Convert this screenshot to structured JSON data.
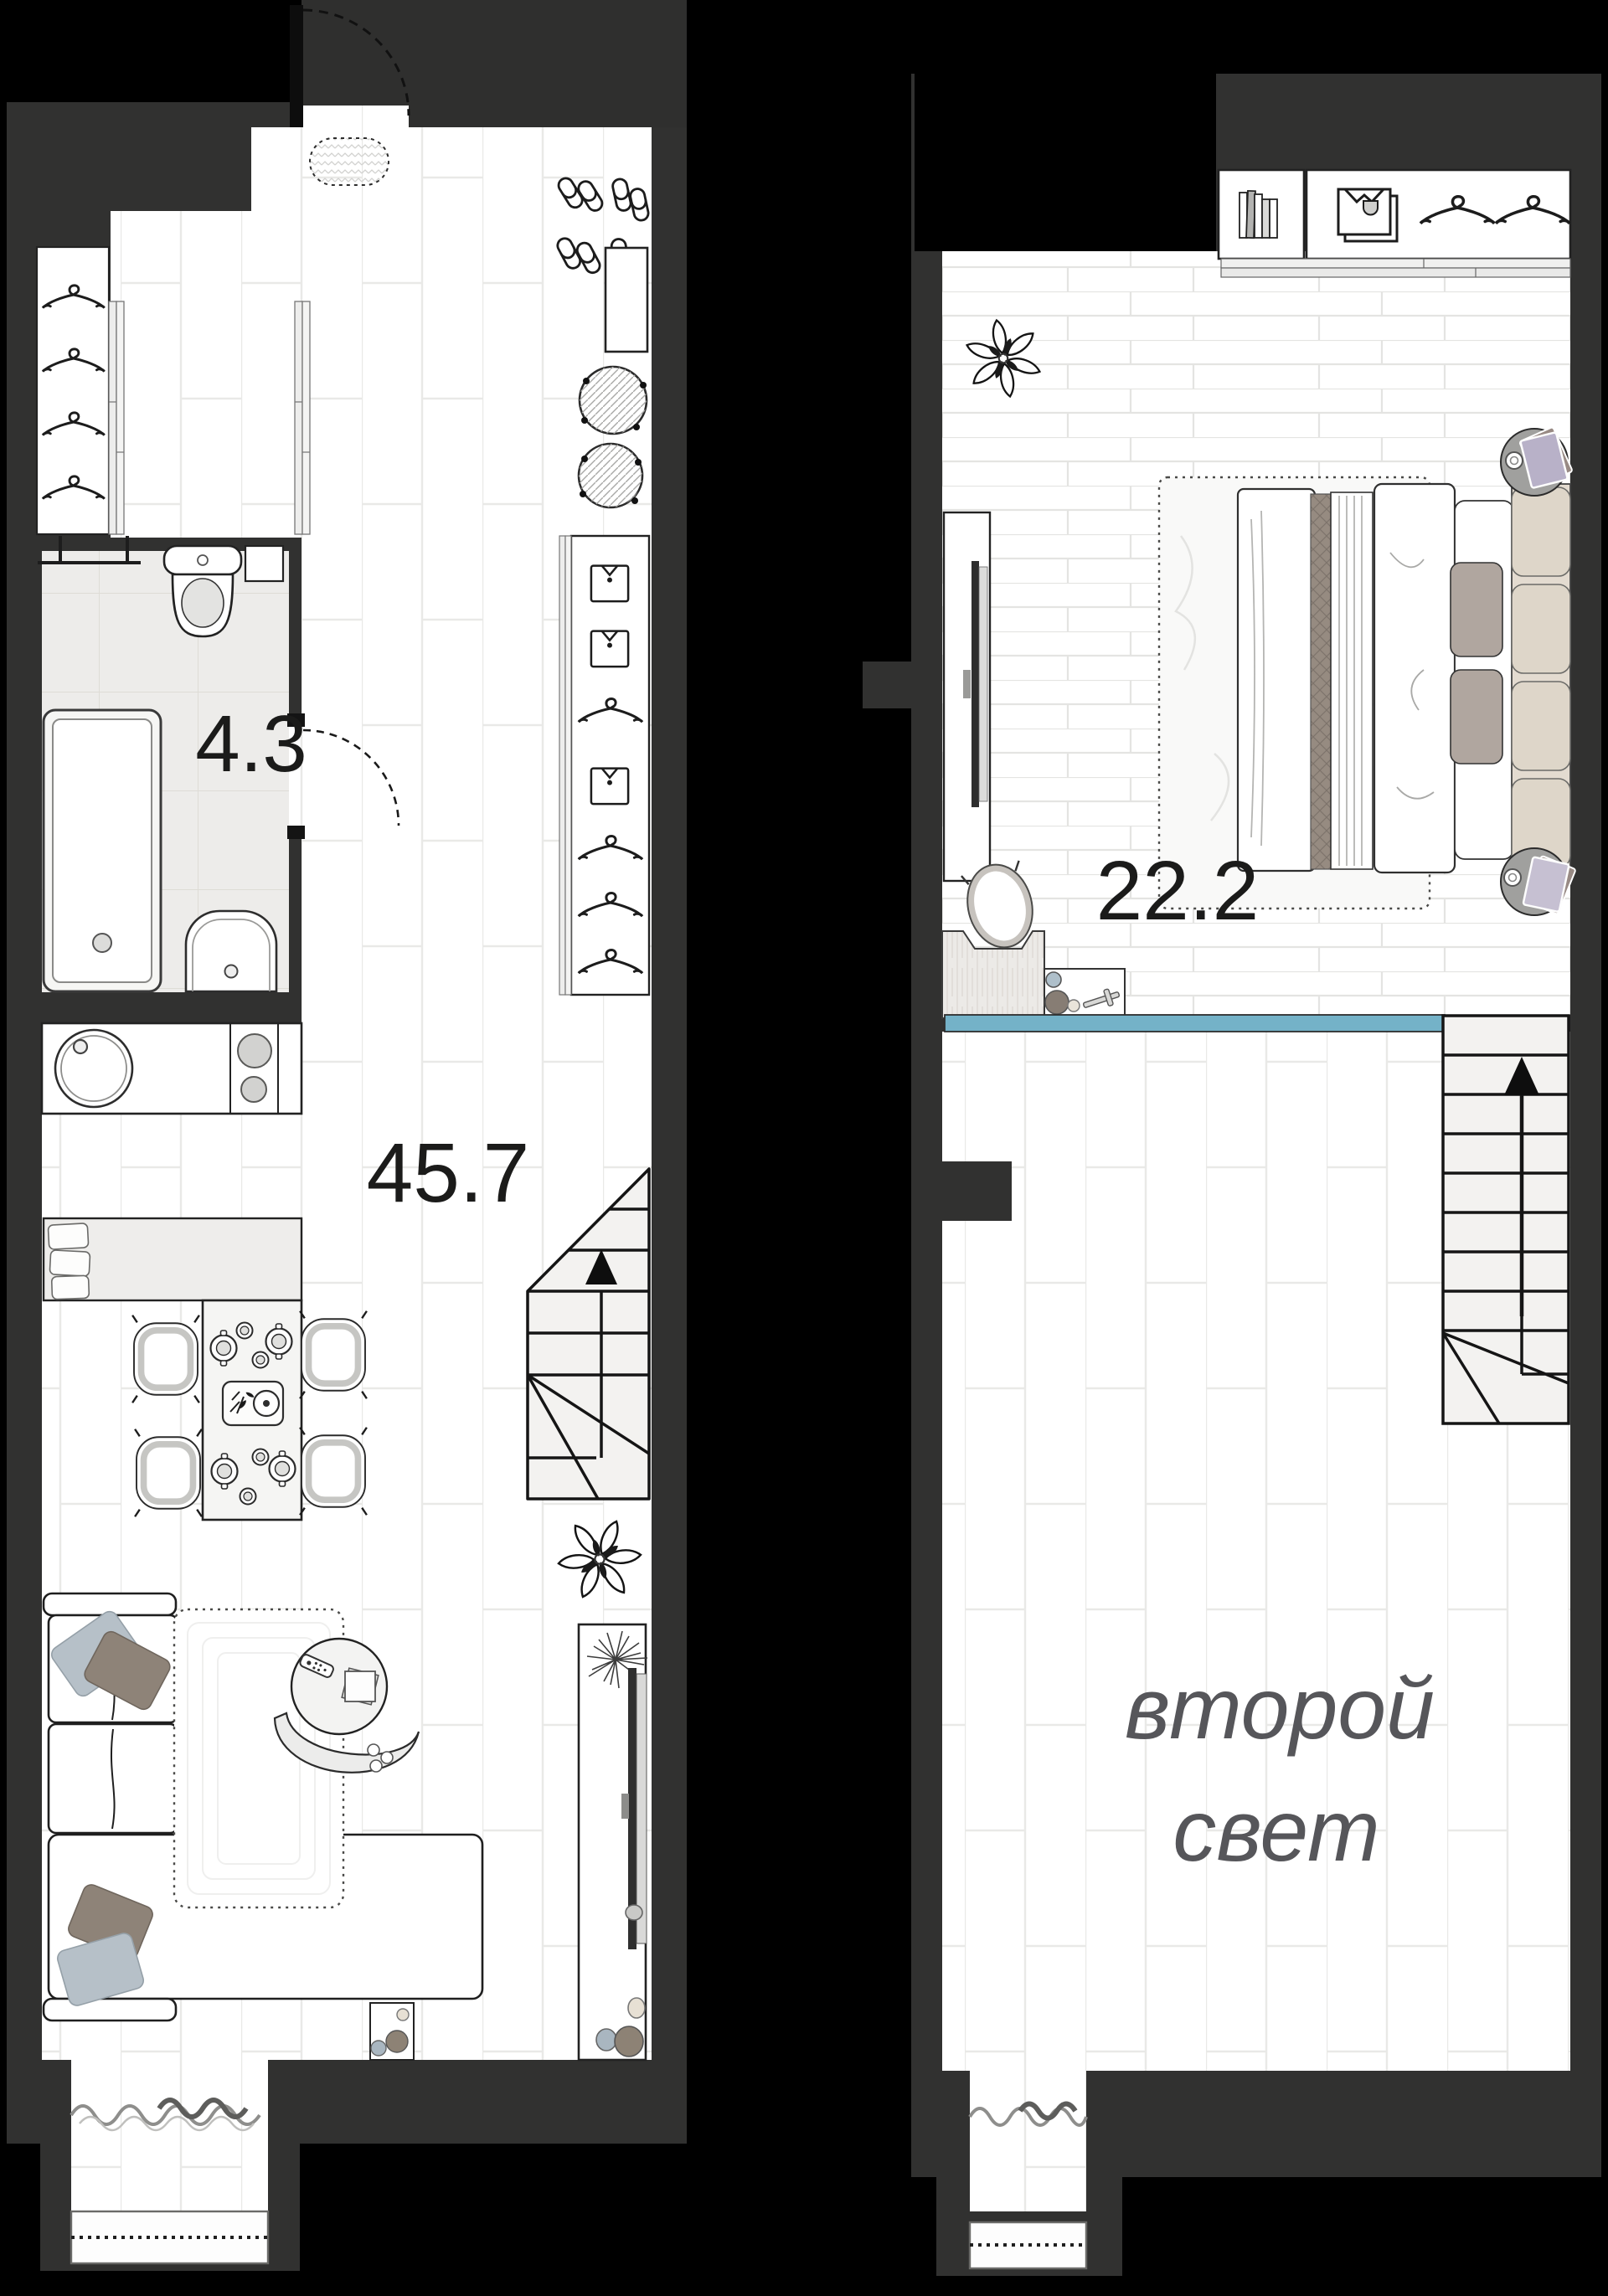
{
  "page": {
    "type": "apartment floor plan, two levels",
    "background": "#000000"
  },
  "palette": {
    "wall": "#313130",
    "wall_light_patch": "#2f2f2e",
    "floor": "#ffffff",
    "floor_line": "#e9e9e7",
    "bathroom_tile": "#edecea",
    "stairs_fill": "#f3f2f0",
    "railing_blue": "#74b2c8",
    "area_label_color": "#1b1b1a",
    "void_label_color": "#56565a",
    "pillow_blue": "#b6c0c8",
    "pillow_brown": "#8e8378",
    "headboard_beige": "#ded6c9",
    "nightstand_gray": "#a0a09e",
    "book_lavender": "#b8b1c8"
  },
  "labels": {
    "bathroom_area": "4.3",
    "living_area": "45.7",
    "bedroom_area": "22.2",
    "void_line1": "второй",
    "void_line2": "свет"
  },
  "levels": [
    {
      "name": "first floor",
      "rooms": [
        {
          "id": "bathroom",
          "area_label": "4.3"
        },
        {
          "id": "hall-kitchen-living",
          "area_label": "45.7"
        }
      ]
    },
    {
      "name": "second floor",
      "rooms": [
        {
          "id": "bedroom",
          "area_label": "22.2"
        },
        {
          "id": "second-light-void",
          "label": "второй свет"
        }
      ]
    }
  ],
  "icons": {
    "entry-door": "door leaf with dashed swing arc",
    "doormat": "dashed oval mat with chevron texture",
    "slippers": "four pairs of slippers",
    "shoe-cabinet": "rectangle cabinet",
    "pouf": "hatched circle with four buttons",
    "hanger": "clothes hanger",
    "shirt": "hanging shirt",
    "folded-shirt": "folded shirt stack",
    "books": "row of books",
    "towel-rail": "wall towel rail",
    "toilet": "toilet top view",
    "bathtub": "bathtub top view",
    "washbasin": "basin with tap",
    "kitchen-sink": "round sink with tap",
    "stove": "two burner hob",
    "dining-table": "table with plates and tray",
    "chair": "dining chair top view",
    "bench": "kitchen bench with cushions",
    "stairs": "staircase with up arrow",
    "sofa": "corner sofa with pillows",
    "rug": "dashed-border rug",
    "coffee-table": "round table with remote and book",
    "lounge-chair": "crescent lounge chair",
    "plant": "leafy plant",
    "dried-plant": "dandelion twig bunch",
    "tv": "tv panel on console",
    "vases": "decor vessels",
    "bed": "double bed with duvet and pillows",
    "nightstand": "round nightstand with book and cup",
    "desk": "wood desk with egg chair",
    "side-table": "console with vases and model airplane",
    "glass-railing": "blue balustrade line",
    "curtain": "wavy curtain line",
    "window": "window with dotted glazing line"
  }
}
